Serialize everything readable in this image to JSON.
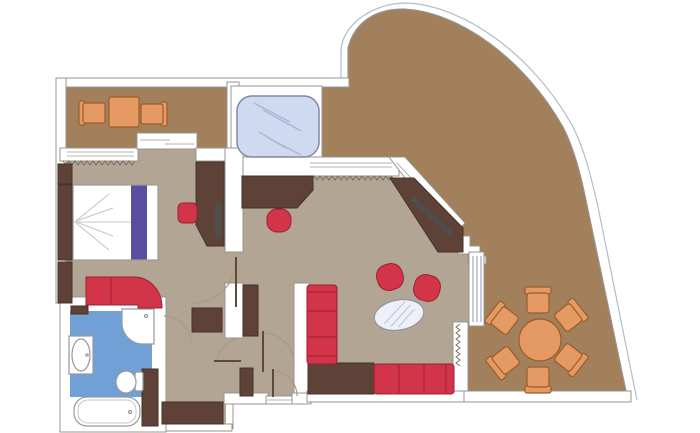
{
  "title": "Suite floor plan with wrap-around terrace",
  "palette": {
    "page": "#ffffff",
    "wall": "#ffffff",
    "wall_line": "#97948f",
    "terrace": "#a1805b",
    "floor": "#b2a593",
    "bath_floor": "#70a0d6",
    "dark_wood": "#5e4237",
    "dark_wood_line": "#45312a",
    "red": "#d2344a",
    "red_line": "#9c2033",
    "orange": "#e59a64",
    "orange_line": "#9c5c28",
    "white_fix": "#ffffff",
    "fix_line": "#98989b",
    "fix_inner": "#c6c6c4",
    "whirl": "#cfdaf0",
    "whirl_line": "#7e89a5",
    "whirl_glint": "#a9b6d8",
    "glass": "#edf0f7",
    "glass_line": "#8b94a8",
    "glass_hatch": "#b9c2d8",
    "glazing": "#b5b3b0",
    "purple": "#5b4ea0",
    "tv": "#4e4e4e",
    "curtain": "#7d6e5d",
    "hull": "#aebecb",
    "door_arc": "#a89a86",
    "door_leaf": "#5f4a3a",
    "bed_line": "#9a9a98",
    "bed_crease": "#c4c4c2"
  },
  "rooms": {
    "balcony": {
      "name": "private balcony",
      "furniture": [
        "armchair",
        "side-table",
        "armchair"
      ]
    },
    "whirlpool_niche": {
      "name": "whirlpool bay",
      "furniture": [
        "whirlpool-bath"
      ]
    },
    "bedroom": {
      "name": "bedroom",
      "furniture": [
        "wardrobe",
        "headboard",
        "double-bed",
        "bed-runner",
        "ottoman",
        "vanity-desk",
        "tv",
        "sofa",
        "wardrobe"
      ]
    },
    "bathroom": {
      "name": "bathroom",
      "furniture": [
        "shelf",
        "shower",
        "washbasin",
        "toilet",
        "bathtub",
        "vanity-cabinet"
      ]
    },
    "hallway": {
      "name": "entrance hall / dressing",
      "furniture": [
        "closet",
        "closet",
        "closet",
        "closet"
      ],
      "doors": 5
    },
    "living_room": {
      "name": "living / dining room",
      "furniture": [
        "desk",
        "desk-chair",
        "tv-sideboard",
        "armchair",
        "armchair",
        "oval-coffee-table",
        "corner-table",
        "corner-sofa",
        "sofa"
      ]
    },
    "terrace": {
      "name": "wrap-around terrace",
      "furniture": [
        "round-dining-table",
        "chair",
        "chair",
        "chair",
        "chair",
        "chair",
        "chair"
      ]
    }
  }
}
